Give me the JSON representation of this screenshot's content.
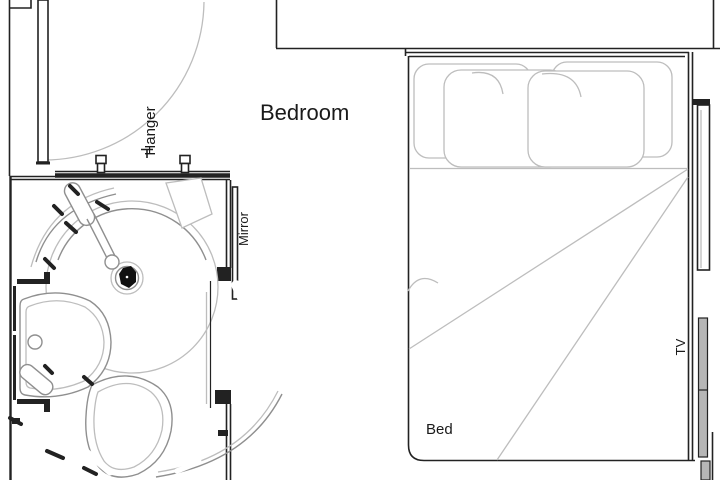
{
  "labels": {
    "bedroom": "Bedroom",
    "hanger": "Hanger",
    "mirror": "Mirror",
    "bed": "Bed",
    "tv": "TV"
  },
  "colors": {
    "wall": "#222222",
    "line_light": "#bdbdbd",
    "line_mid": "#8f8f8f",
    "tv_fill": "#b6b6b6",
    "text": "#1a1a1a",
    "background": "#ffffff"
  }
}
